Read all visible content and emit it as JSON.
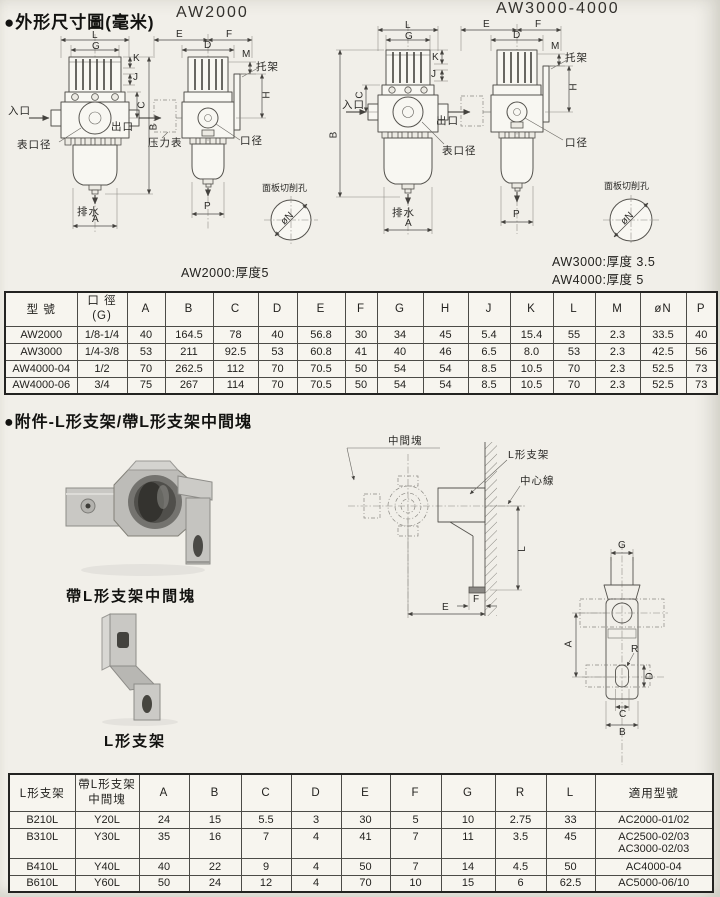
{
  "section1": {
    "title": "●外形尺寸圖(毫米)"
  },
  "models": {
    "aw2000": {
      "title": "AW2000",
      "note": "AW2000:厚度5"
    },
    "aw3000": {
      "title": "AW3000-4000",
      "note1": "AW3000:厚度 3.5",
      "note2": "AW4000:厚度 5"
    }
  },
  "labels": {
    "A": "A",
    "B": "B",
    "C": "C",
    "D": "D",
    "E": "E",
    "F": "F",
    "G": "G",
    "H": "H",
    "J": "J",
    "K": "K",
    "L": "L",
    "M": "M",
    "P": "P",
    "R": "R",
    "inlet": "入口",
    "outlet": "出口",
    "gauge_port": "表口径",
    "drain": "排水",
    "pressure_gauge": "压力表",
    "port": "口径",
    "bracket": "托架",
    "panel_hole": "面板切削孔",
    "panel_dia": "øN"
  },
  "table1": {
    "col_model": "型 號",
    "col_port_1": "口 徑",
    "col_port_2": "(G)",
    "dims": [
      "A",
      "B",
      "C",
      "D",
      "E",
      "F",
      "G",
      "H",
      "J",
      "K",
      "L",
      "M",
      "øN",
      "P"
    ],
    "rows": [
      {
        "model": "AW2000",
        "port": "1/8-1/4",
        "v": [
          "40",
          "164.5",
          "78",
          "40",
          "56.8",
          "30",
          "34",
          "45",
          "5.4",
          "15.4",
          "55",
          "2.3",
          "33.5",
          "40"
        ]
      },
      {
        "model": "AW3000",
        "port": "1/4-3/8",
        "v": [
          "53",
          "211",
          "92.5",
          "53",
          "60.8",
          "41",
          "40",
          "46",
          "6.5",
          "8.0",
          "53",
          "2.3",
          "42.5",
          "56"
        ]
      },
      {
        "model": "AW4000-04",
        "port": "1/2",
        "v": [
          "70",
          "262.5",
          "112",
          "70",
          "70.5",
          "50",
          "54",
          "54",
          "8.5",
          "10.5",
          "70",
          "2.3",
          "52.5",
          "73"
        ]
      },
      {
        "model": "AW4000-06",
        "port": "3/4",
        "v": [
          "75",
          "267",
          "114",
          "70",
          "70.5",
          "50",
          "54",
          "54",
          "8.5",
          "10.5",
          "70",
          "2.3",
          "52.5",
          "73"
        ]
      }
    ]
  },
  "section2": {
    "title": "●附件-L形支架/帶L形支架中間塊",
    "caption_block": "帶L形支架中間塊",
    "caption_bracket": "L形支架",
    "diagram": {
      "middle_block": "中間塊",
      "l_bracket": "L形支架",
      "center_line": "中心線"
    }
  },
  "table2": {
    "col_bracket": "L形支架",
    "col_block_1": "帶L形支架",
    "col_block_2": "中間塊",
    "dims": [
      "A",
      "B",
      "C",
      "D",
      "E",
      "F",
      "G",
      "R",
      "L"
    ],
    "col_models": "適用型號",
    "rows": [
      {
        "bracket": "B210L",
        "block": "Y20L",
        "v": [
          "24",
          "15",
          "5.5",
          "3",
          "30",
          "5",
          "10",
          "2.75",
          "33"
        ],
        "m1": "AC2000-01/02",
        "m2": ""
      },
      {
        "bracket": "B310L",
        "block": "Y30L",
        "v": [
          "35",
          "16",
          "7",
          "4",
          "41",
          "7",
          "11",
          "3.5",
          "45"
        ],
        "m1": "AC2500-02/03",
        "m2": "AC3000-02/03"
      },
      {
        "bracket": "B410L",
        "block": "Y40L",
        "v": [
          "40",
          "22",
          "9",
          "4",
          "50",
          "7",
          "14",
          "4.5",
          "50"
        ],
        "m1": "AC4000-04",
        "m2": ""
      },
      {
        "bracket": "B610L",
        "block": "Y60L",
        "v": [
          "50",
          "24",
          "12",
          "4",
          "70",
          "10",
          "15",
          "6",
          "62.5"
        ],
        "m1": "AC5000-06/10",
        "m2": ""
      }
    ]
  }
}
